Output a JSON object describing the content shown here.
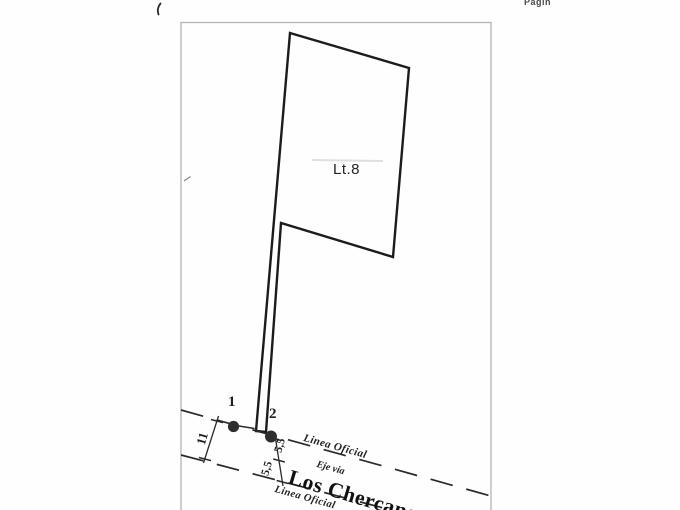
{
  "page": {
    "corner_text": "Pagin"
  },
  "plan": {
    "lot_label": "Lt.8",
    "points": {
      "p1": "1",
      "p2": "2"
    },
    "road": {
      "official_line_top": "Linea Oficial",
      "official_line_bottom": "Linea Oficial",
      "axis_label": "Eje via",
      "name": "Los Chercanes"
    },
    "dimensions": {
      "total_width": "11",
      "half_width_top": "5,5",
      "half_width_bottom": "5,5"
    }
  },
  "colors": {
    "ink": "#1f1f1f",
    "frame": "#b4b4b4",
    "muted": "#4a4a4a"
  }
}
